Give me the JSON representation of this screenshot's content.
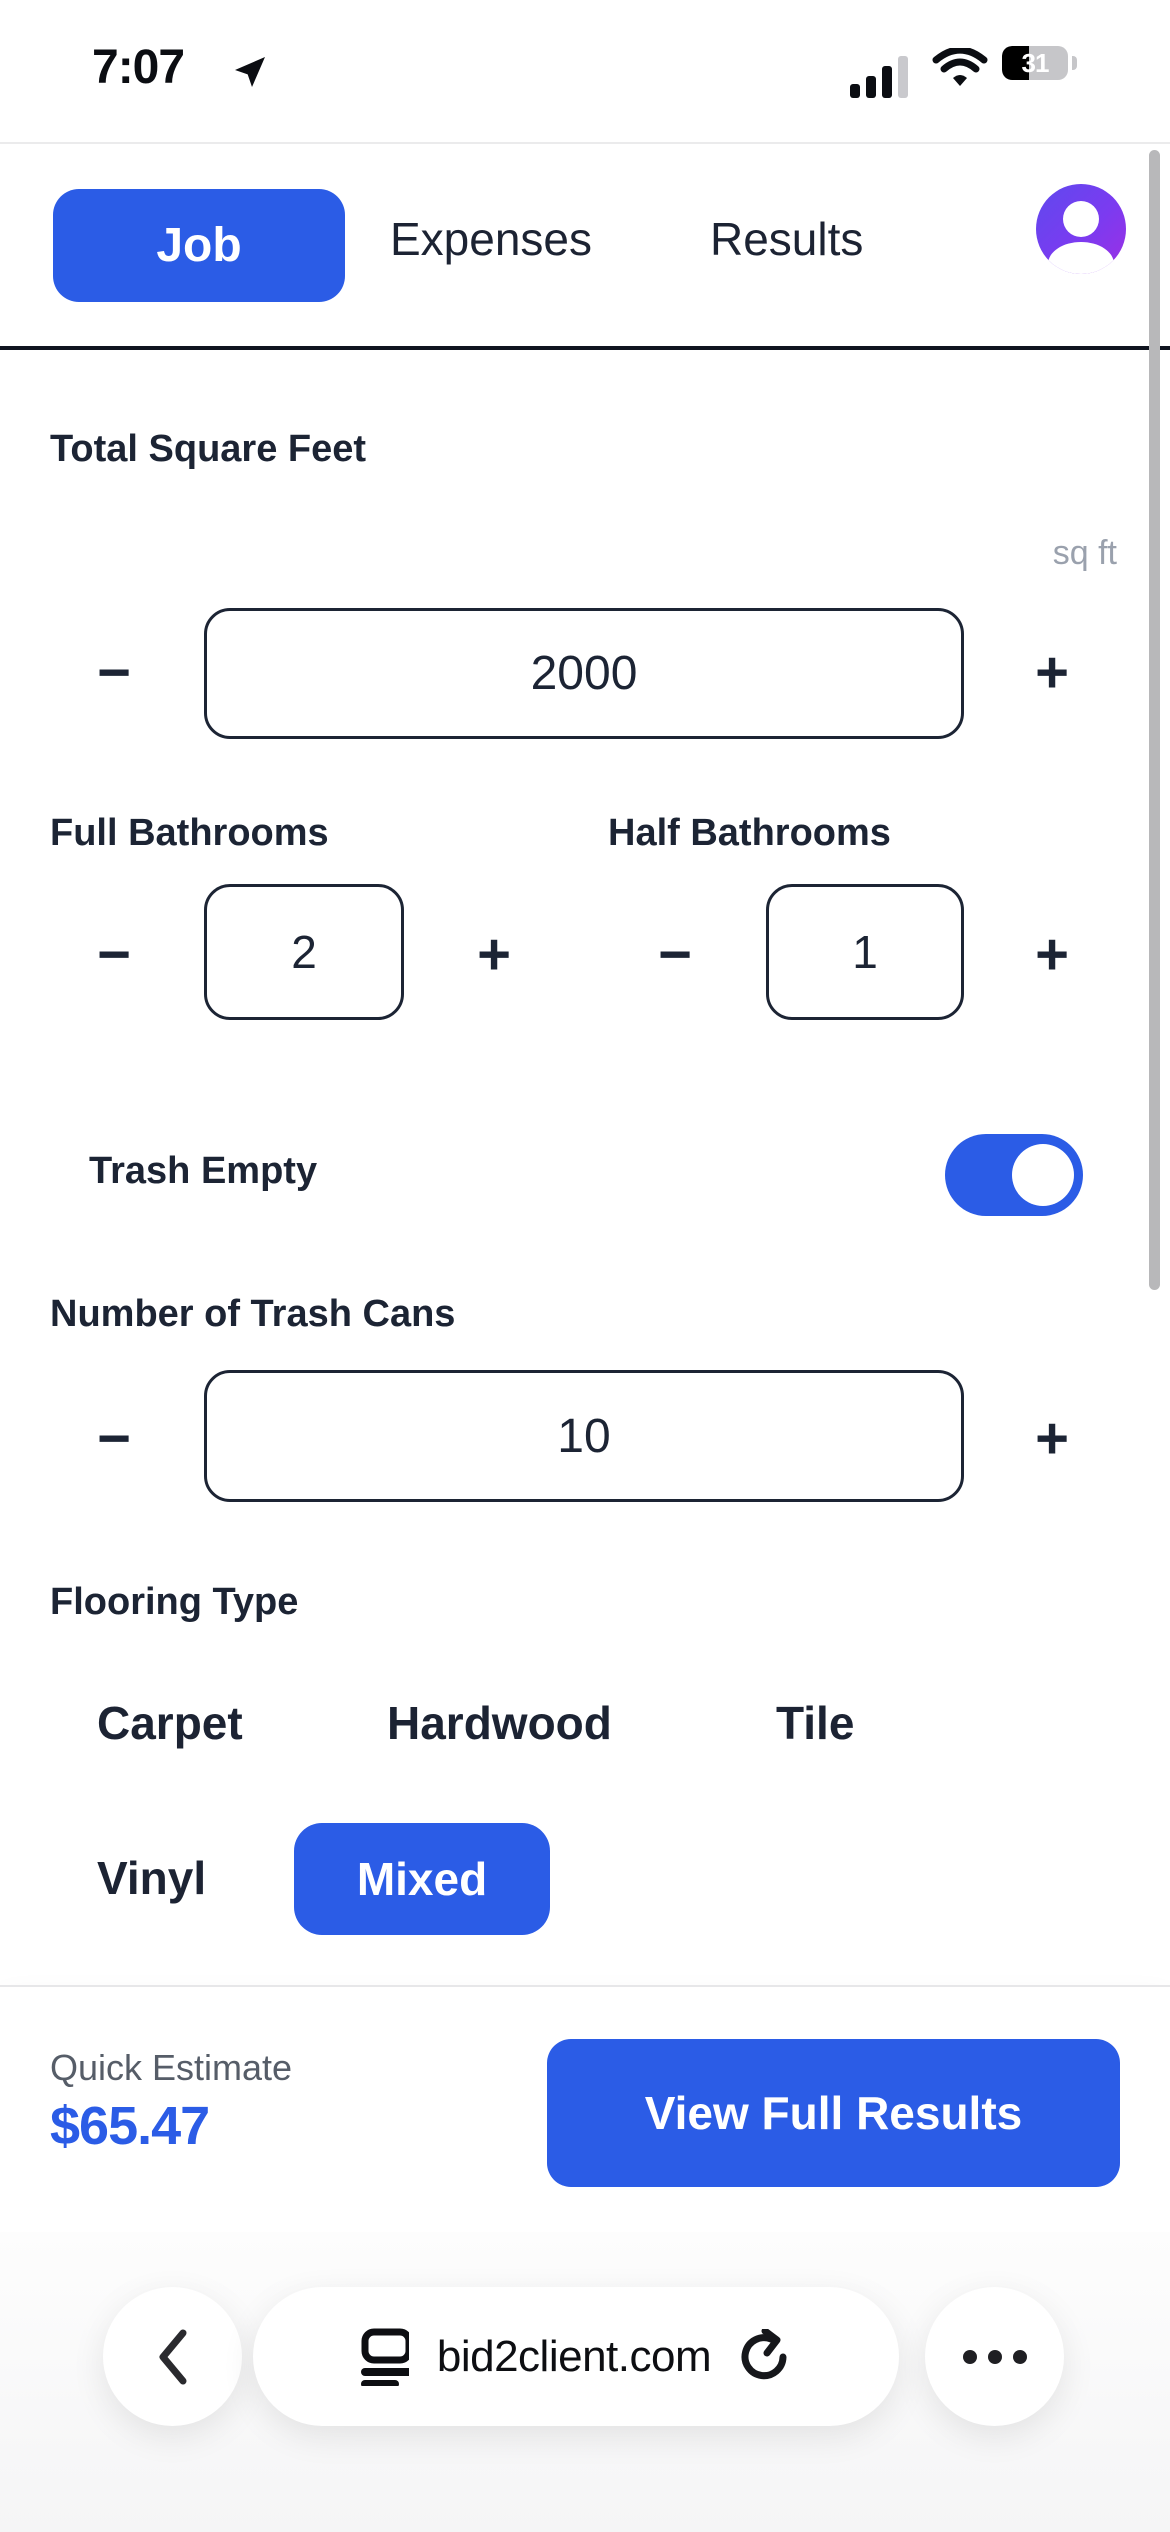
{
  "status": {
    "time": "7:07",
    "battery_percent": "31"
  },
  "header": {
    "tab_job": "Job",
    "tab_expenses": "Expenses",
    "tab_results": "Results",
    "active_tab": "Job"
  },
  "controls": {
    "minus": "−",
    "plus": "+"
  },
  "form": {
    "square_feet": {
      "label": "Total Square Feet",
      "unit": "sq ft",
      "value": "2000"
    },
    "full_bathrooms": {
      "label": "Full Bathrooms",
      "value": "2"
    },
    "half_bathrooms": {
      "label": "Half Bathrooms",
      "value": "1"
    },
    "trash_empty": {
      "label": "Trash Empty",
      "enabled": true
    },
    "trash_cans": {
      "label": "Number of Trash Cans",
      "value": "10"
    },
    "flooring": {
      "label": "Flooring Type",
      "options": [
        "Carpet",
        "Hardwood",
        "Tile",
        "Vinyl",
        "Mixed"
      ],
      "selected": "Mixed"
    }
  },
  "estimate": {
    "label": "Quick Estimate",
    "amount": "$65.47",
    "cta": "View Full Results"
  },
  "browser": {
    "url": "bid2client.com"
  },
  "colors": {
    "accent": "#2b5ce6",
    "text_dark": "#1c2434",
    "muted_gray": "#9aa1ad",
    "avatar_gradient_start": "#5f49ee",
    "avatar_gradient_end": "#9d2fe4"
  }
}
